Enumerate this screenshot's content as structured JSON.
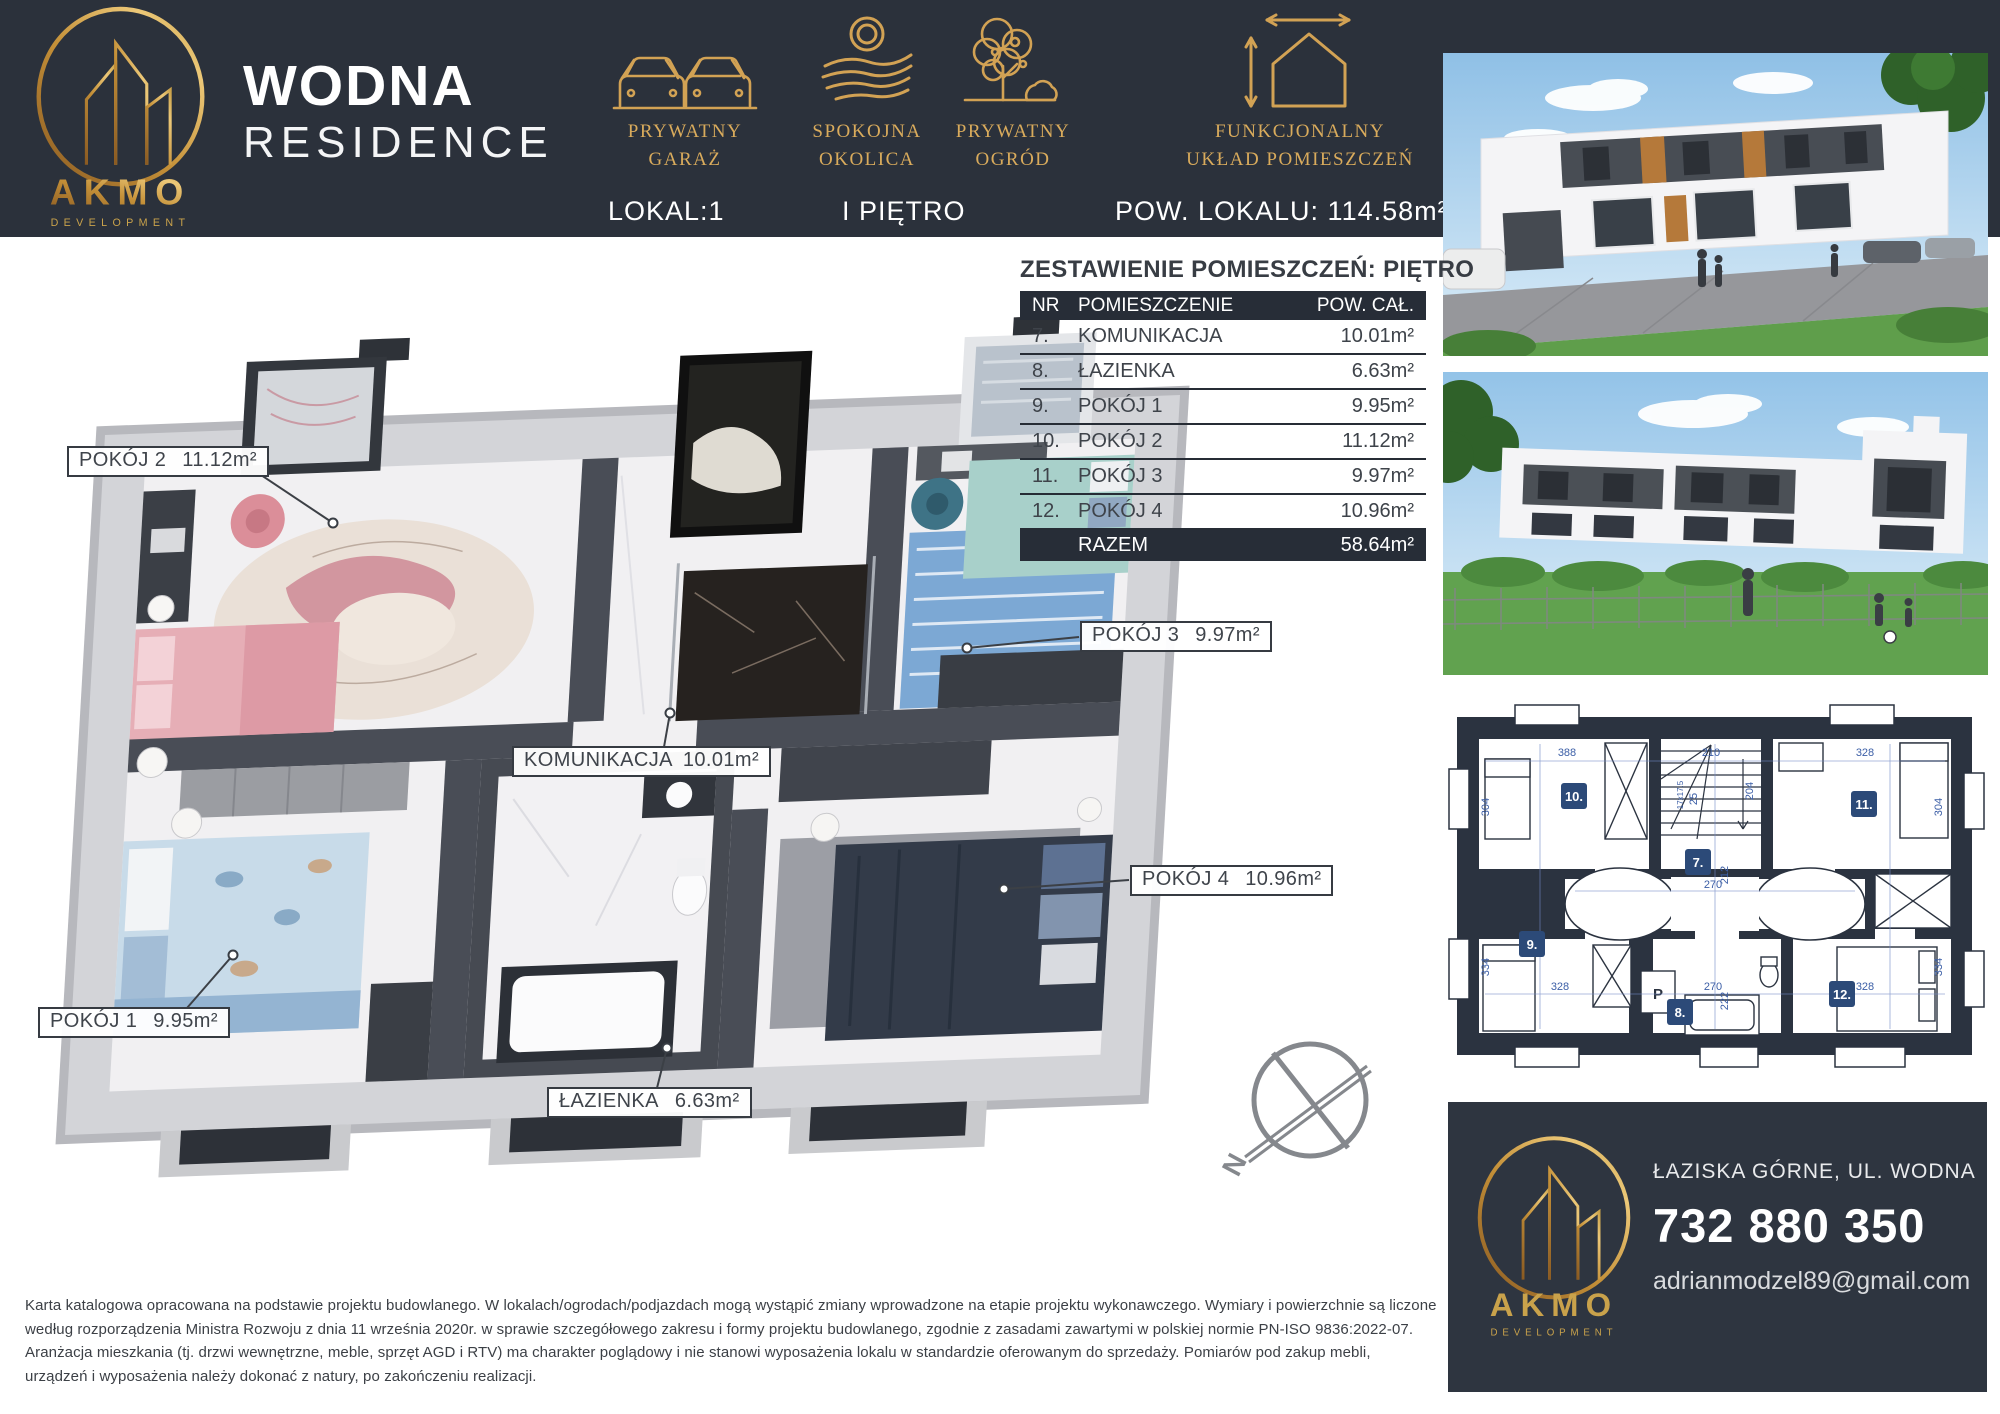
{
  "header": {
    "brand": {
      "name": "AKMO",
      "subtitle": "DEVELOPMENT"
    },
    "title_line1": "WODNA",
    "title_line2": "RESIDENCE",
    "features": [
      {
        "icon": "cars-icon",
        "line1": "PRYWATNY",
        "line2": "GARAŻ"
      },
      {
        "icon": "landscape-icon",
        "line1": "SPOKOJNA",
        "line2": "OKOLICA"
      },
      {
        "icon": "tree-icon",
        "line1": "PRYWATNY",
        "line2": "OGRÓD"
      },
      {
        "icon": "house-dimensions-icon",
        "line1": "FUNKCJONALNY",
        "line2": "UKŁAD POMIESZCZEŃ"
      }
    ],
    "info": {
      "lokal": "LOKAL:1",
      "pietro": "I PIĘTRO",
      "pow": "POW. LOKALU: 114.58m²"
    }
  },
  "rooms_table": {
    "title": "ZESTAWIENIE POMIESZCZEŃ: PIĘTRO",
    "columns": {
      "nr": "NR",
      "name": "POMIESZCZENIE",
      "area": "POW. CAŁ."
    },
    "rows": [
      {
        "nr": "7.",
        "name": "KOMUNIKACJA",
        "area": "10.01m²"
      },
      {
        "nr": "8.",
        "name": "ŁAZIENKA",
        "area": "6.63m²"
      },
      {
        "nr": "9.",
        "name": "POKÓJ 1",
        "area": "9.95m²"
      },
      {
        "nr": "10.",
        "name": "POKÓJ 2",
        "area": "11.12m²"
      },
      {
        "nr": "11.",
        "name": "POKÓJ 3",
        "area": "9.97m²"
      },
      {
        "nr": "12.",
        "name": "POKÓJ 4",
        "area": "10.96m²"
      }
    ],
    "total_label": "RAZEM",
    "total_area": "58.64m²"
  },
  "floor_plan_labels": {
    "pokoj2": {
      "name": "POKÓJ 2",
      "area": "11.12m²"
    },
    "pokoj3": {
      "name": "POKÓJ 3",
      "area": "9.97m²"
    },
    "komunikacja": {
      "name": "KOMUNIKACJA",
      "area": "10.01m²"
    },
    "pokoj4": {
      "name": "POKÓJ 4",
      "area": "10.96m²"
    },
    "pokoj1": {
      "name": "POKÓJ 1",
      "area": "9.95m²"
    },
    "lazienka": {
      "name": "ŁAZIENKA",
      "area": "6.63m²"
    },
    "compass_letter": "N"
  },
  "plan2d": {
    "badges": {
      "b7": "7.",
      "b8": "8.",
      "b9": "9.",
      "b10": "10.",
      "b11": "11.",
      "b12": "12."
    },
    "p_label": "P",
    "dims": {
      "top_left": "388",
      "top_mid": "210",
      "top_right": "328",
      "left_top": "304",
      "left_bottom": "334",
      "right_top": "304",
      "right_bottom": "334",
      "mid_h1": "270",
      "mid_v1": "212",
      "mid_h2": "270",
      "mid_v2": "222",
      "stairs_v": "204",
      "stairs_w": "25",
      "stairs_step": "17x17.5",
      "bottom_left": "328",
      "bottom_mid": "270",
      "bottom_right": "328"
    }
  },
  "contact": {
    "brand": "AKMO",
    "brand_sub": "DEVELOPMENT",
    "address": "ŁAZISKA GÓRNE, UL. WODNA",
    "phone": "732 880 350",
    "email": "adrianmodzel89@gmail.com"
  },
  "disclaimer": "Karta katalogowa opracowana na podstawie projektu budowlanego. W lokalach/ogrodach/podjazdach mogą wystąpić zmiany wprowadzone na etapie projektu wykonawczego. Wymiary i powierzchnie są liczone według rozporządzenia Ministra Rozwoju z dnia 11 września 2020r.  w sprawie szczegółowego zakresu i formy projektu budowlanego, zgodnie z zasadami zawartymi w polskiej normie PN-ISO 9836:2022-07. Aranżacja mieszkania (tj. drzwi wewnętrzne, meble, sprzęt AGD i RTV) ma charakter poglądowy i nie stanowi wyposażenia lokalu w standardzie oferowanym do sprzedaży. Pomiarów pod zakup mebli, urządzeń i wyposażenia należy dokonać z natury, po zakończeniu realizacji.",
  "colors": {
    "header_bg": "#2b313b",
    "gold": "#c79b4e",
    "table_dark": "#272d37",
    "plan_navy": "#2b3340",
    "badge_blue": "#2c4a78",
    "dim_blue": "#3b5ea6"
  }
}
